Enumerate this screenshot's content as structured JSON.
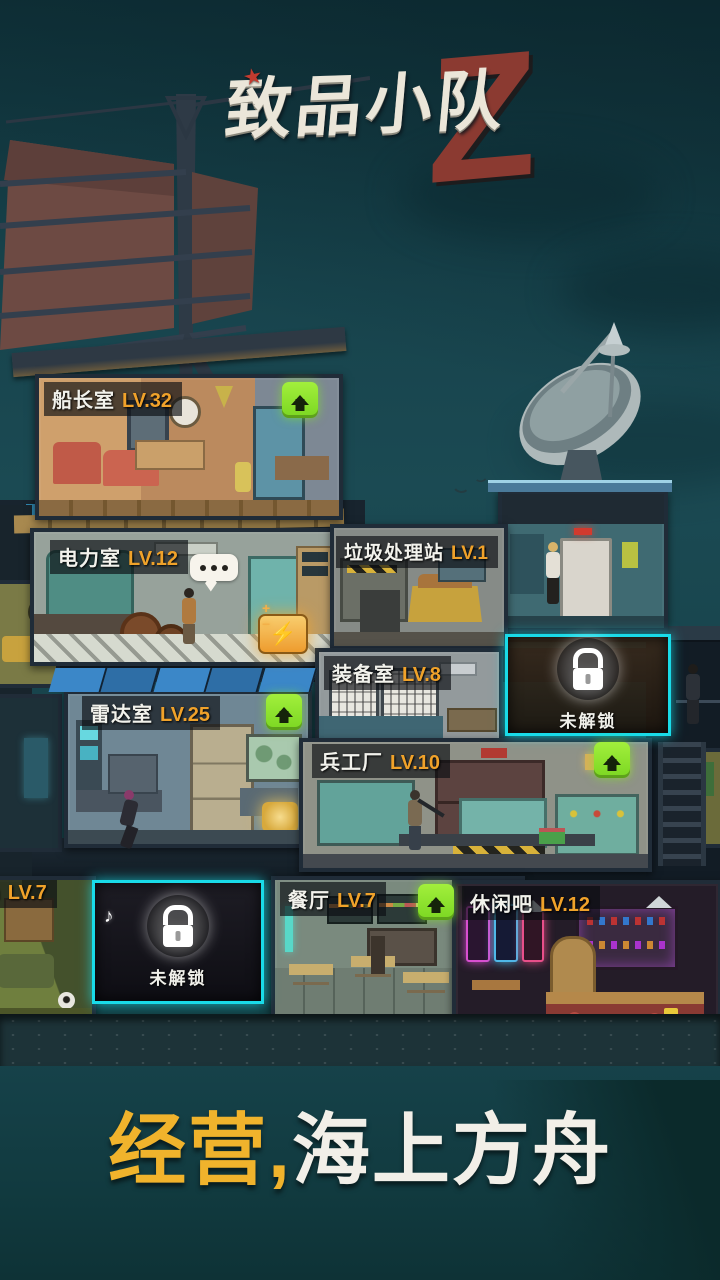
{
  "title": {
    "text": "致品小队",
    "z_badge": "Z",
    "star": "★"
  },
  "rooms": [
    {
      "id": "captain",
      "name": "船长室",
      "level": "LV.32",
      "has_upgrade": true
    },
    {
      "id": "power",
      "name": "电力室",
      "level": "LV.12",
      "has_upgrade": false
    },
    {
      "id": "garbage",
      "name": "垃圾处理站",
      "level": "LV.1",
      "has_upgrade": false
    },
    {
      "id": "equipment",
      "name": "装备室",
      "level": "LV.8",
      "has_upgrade": false
    },
    {
      "id": "radar",
      "name": "雷达室",
      "level": "LV.25",
      "has_upgrade": true
    },
    {
      "id": "arsenal",
      "name": "兵工厂",
      "level": "LV.10",
      "has_upgrade": true
    },
    {
      "id": "gym",
      "name": "m",
      "level": "LV.7",
      "has_upgrade": false
    },
    {
      "id": "restaurant",
      "name": "餐厅",
      "level": "LV.7",
      "has_upgrade": true
    },
    {
      "id": "bar",
      "name": "休闲吧",
      "level": "LV.12",
      "has_upgrade": false
    }
  ],
  "locked": {
    "label": "未解锁"
  },
  "tagline": {
    "highlight": "经营,",
    "rest": "海上方舟"
  },
  "icons": {
    "bolt": "⚡",
    "music_note": "♪",
    "dots": "..."
  },
  "colors": {
    "accent_cyan": "#19dbe8",
    "level_orange": "#f0a22a",
    "upgrade_green": "#8ce82e",
    "tagline_yellow": "#f0b32c",
    "title_red": "#8b3a31"
  }
}
